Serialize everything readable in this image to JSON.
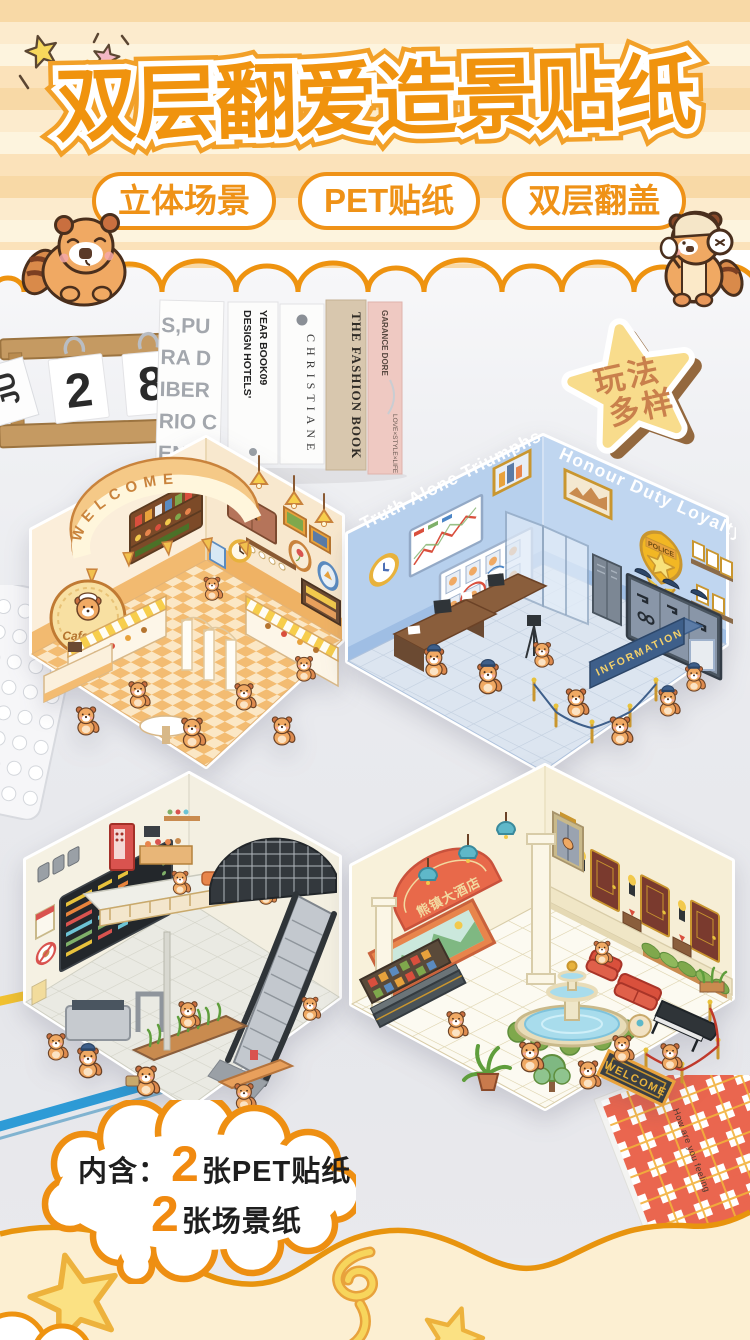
{
  "header": {
    "title": "双层翻爱造景贴纸",
    "badges": [
      {
        "label": "立体场景"
      },
      {
        "label": "PET贴纸"
      },
      {
        "label": "双层翻盖"
      }
    ]
  },
  "photo": {
    "calendar": {
      "month": "JU",
      "day_left": "2",
      "day_right": "8"
    },
    "books": {
      "big_cover_lines": [
        "S,PU",
        "RA D",
        "IBER",
        "RIO C",
        "ENCIA"
      ],
      "design_hotels_line1": "DESIGN HOTELS'",
      "design_hotels_line2": "YEAR BOOK09",
      "christiane": "CHRISTIANE",
      "fashion_book": "THE FASHION BOOK",
      "garance_dore": "GARANCE DORE",
      "garance_sub": "LOVE×STYLE×LIFE"
    },
    "star_badge": {
      "line1": "玩法",
      "line2": "多样"
    }
  },
  "scenes": {
    "cafeteria": {
      "marquee": "WELCOME",
      "logo": "Cafeteria"
    },
    "police": {
      "left_wall_text": "Truth Alone Triumphs",
      "right_wall_text": "Honour Duty Loyalty",
      "badge": "POLICE",
      "info_desk": "INFORMATION"
    },
    "hotel": {
      "sign": "熊镇大酒店",
      "doormat": "WELCOME"
    }
  },
  "bubble": {
    "prefix": "内含：",
    "count_pet": "2",
    "item_pet": "张PET贴纸",
    "count_scene": "2",
    "item_scene": "张场景纸"
  },
  "props": {
    "notebook_text": "How are you feeling"
  },
  "colors": {
    "accent_orange": "#EF9217",
    "title_fill": "#F0930E",
    "cream": "#FCEFD2",
    "police_blue": "#BBD3EE",
    "star_yellow": "#F8DC8C"
  }
}
